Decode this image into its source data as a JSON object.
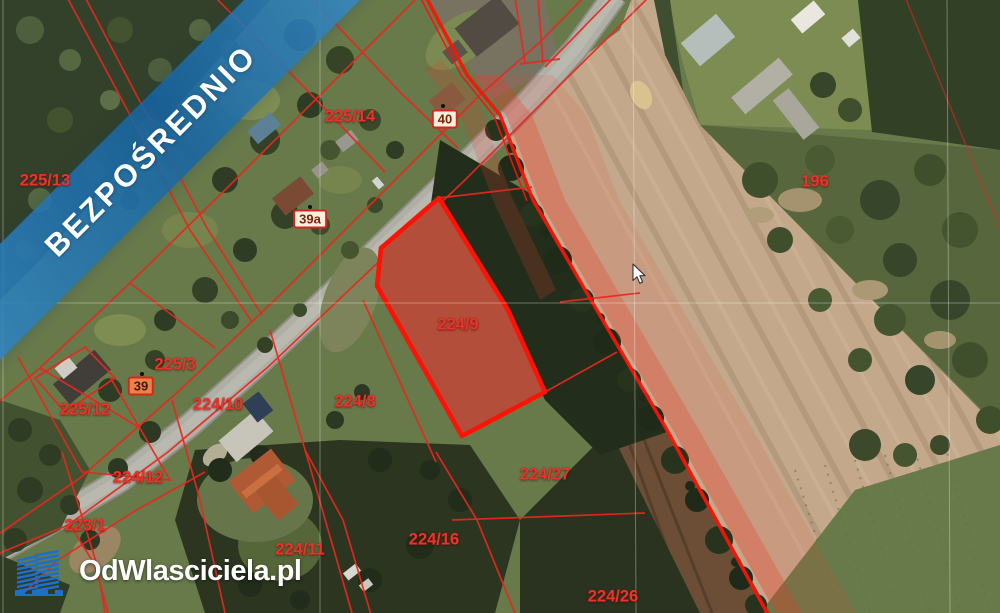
{
  "banner": {
    "text": "BEZPOŚREDNIO",
    "color": "#1f7ab8"
  },
  "logo": {
    "text": "OdWlasciciela.pl",
    "icon": "building-towers-icon",
    "icon_color": "#1d6fc9",
    "text_color": "#ffffff"
  },
  "map": {
    "type": "cadastral-satellite",
    "highlighted_parcel": "224/9",
    "parcel_labels": {
      "p225_13": "225/13",
      "p225_14": "225/14",
      "p196": "196",
      "p225_3": "225/3",
      "p225_12": "225/12",
      "p224_10": "224/10",
      "p224_8": "224/8",
      "p224_9": "224/9",
      "p224_12": "224/12",
      "p224_27": "224/27",
      "p223_1": "223/1",
      "p224_11": "224/11",
      "p224_16": "224/16",
      "p224_26": "224/26"
    },
    "address_markers": {
      "m40": "40",
      "m39a": "39a",
      "m39": "39"
    },
    "colors": {
      "boundary_red": "#e8281e",
      "highlight_stroke": "#ff1205",
      "highlight_fill": "rgba(210,35,25,0.44)",
      "label_red": "#e8352b",
      "marker_fill": "#f8efdc",
      "marker_selected_fill": "#ee8145"
    }
  }
}
